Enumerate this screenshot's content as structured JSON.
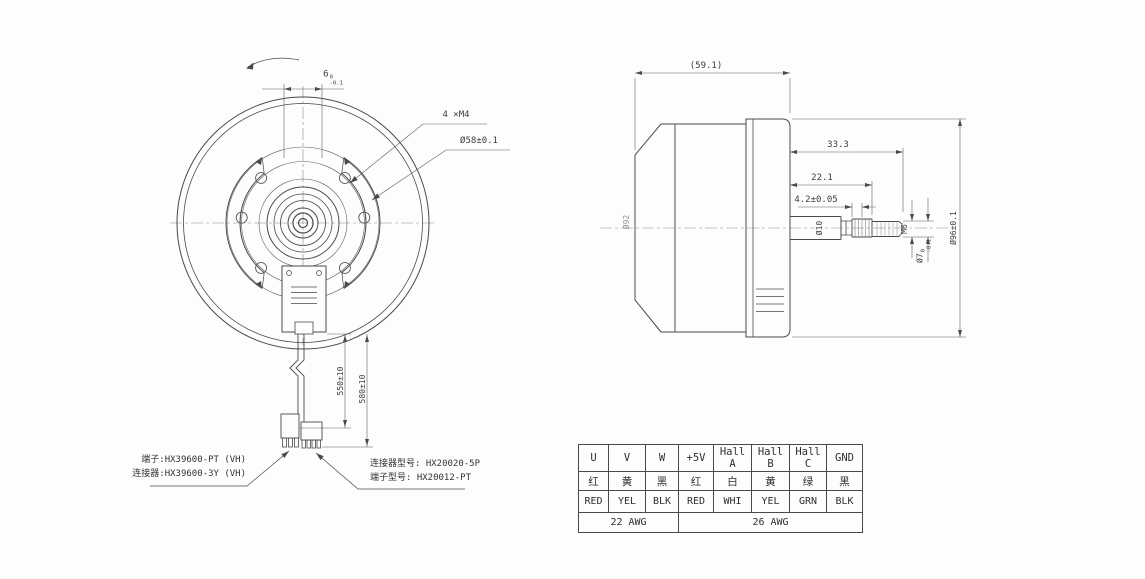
{
  "front_view": {
    "dim_flats": {
      "value": "6",
      "sup": "0",
      "sub": "-0.1"
    },
    "dim_holes": "4 ×M4",
    "dim_bolt_circle": "Ø58±0.1",
    "dim_wire_1": "550±10",
    "dim_wire_2": "580±10",
    "callout_left_line1": "端子:HX39600-PT (VH)",
    "callout_left_line2": "连接器:HX39600-3Y (VH)",
    "callout_right_line1": "连接器型号: HX20020-5P",
    "callout_right_line2": "端子型号: HX20012-PT"
  },
  "side_view": {
    "dim_overall": "(59.1)",
    "dim_shaft_total": "33.3",
    "dim_shaft_step": "22.1",
    "dim_groove": "4.2±0.05",
    "dim_body_dia": "Ø92",
    "dim_shaft_dia": "Ø10",
    "dim_thread": "M6",
    "dim_end_dia": {
      "value": "Ø7",
      "sup": "0",
      "sub": "-0.1"
    },
    "dim_outer_dia": "Ø96±0.1"
  },
  "wiring_table": {
    "headers": [
      "U",
      "V",
      "W",
      "+5V",
      "Hall A",
      "Hall B",
      "Hall C",
      "GND"
    ],
    "colors_cn": [
      "红",
      "黄",
      "黑",
      "红",
      "白",
      "黄",
      "绿",
      "黑"
    ],
    "colors_en": [
      "RED",
      "YEL",
      "BLK",
      "RED",
      "WHI",
      "YEL",
      "GRN",
      "BLK"
    ],
    "awg_left": "22 AWG",
    "awg_right": "26 AWG"
  },
  "colors": {
    "line": "#4a4a4a",
    "thin_line": "#5f5f5f",
    "text": "#3b3b3b",
    "background": "#fdfdfc"
  }
}
